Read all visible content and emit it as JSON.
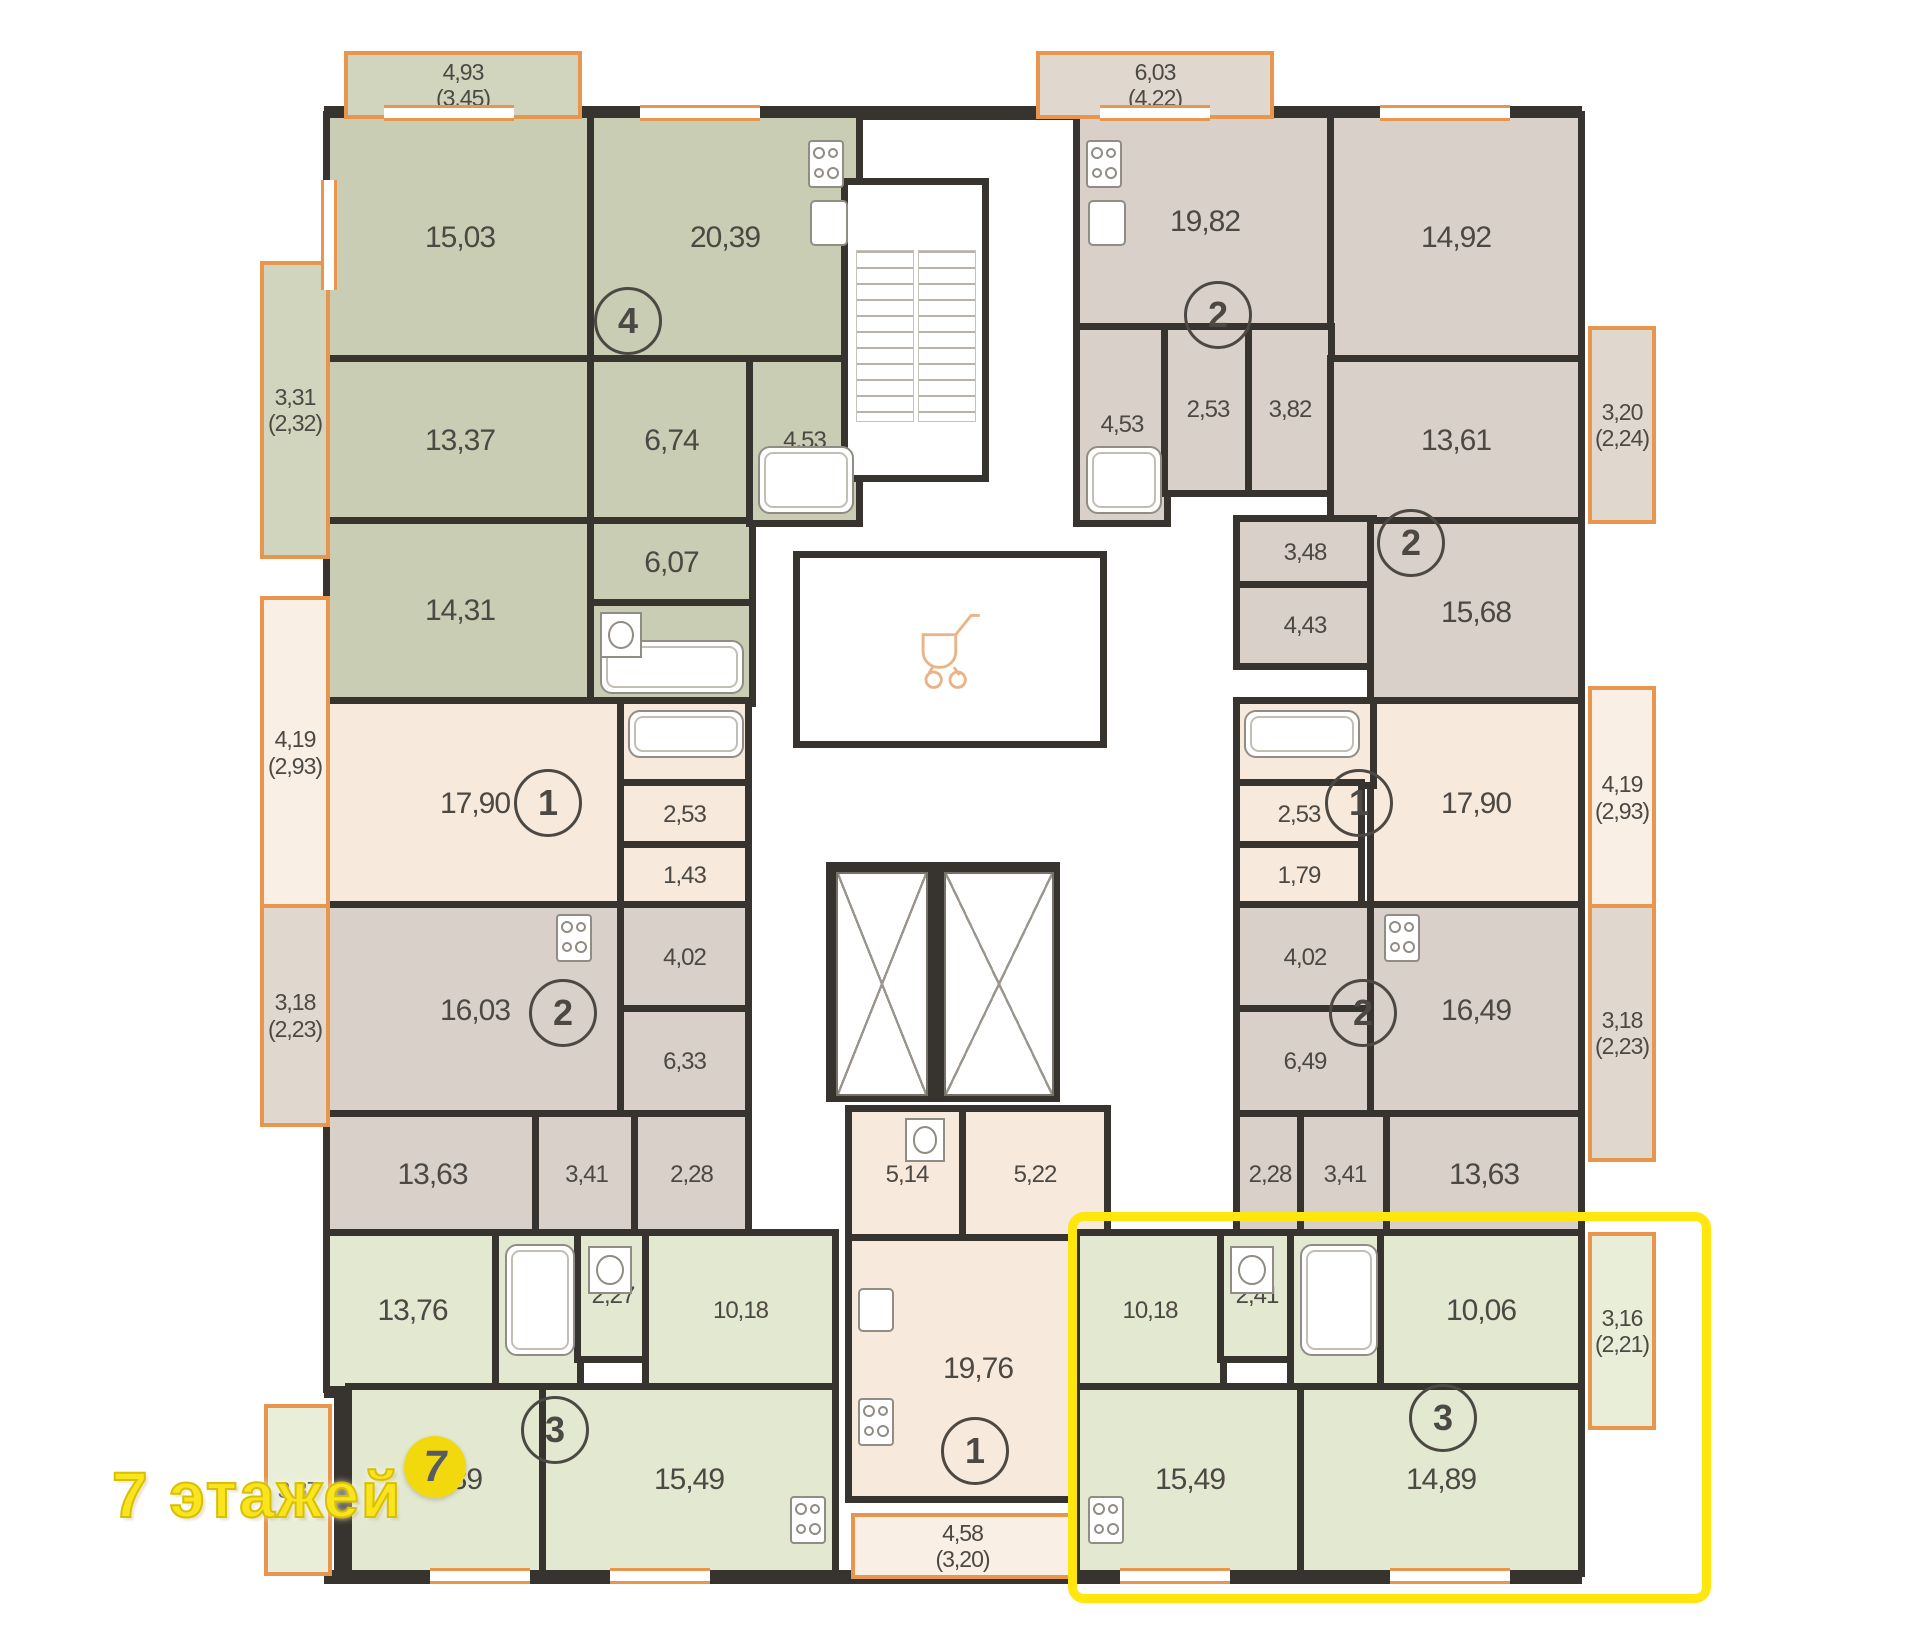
{
  "plan_title": "floor-plan",
  "watermark": {
    "text": "7 этажей",
    "logo_digit": "7"
  },
  "colors": {
    "wall": "#37332f",
    "window_accent": "#e8954e",
    "highlight": "#ffe70d",
    "apt_olive": "#c9cdb3",
    "apt_pink": "#f8e9dd",
    "apt_taupe": "#d9d1c9",
    "apt_green": "#e3e8d1",
    "label_text": "#4c4843"
  },
  "apartments": [
    {
      "number": "4",
      "color_key": "apt_olive",
      "rooms": [
        {
          "area": "15,03"
        },
        {
          "area": "20,39"
        },
        {
          "area": "13,37"
        },
        {
          "area": "6,74"
        },
        {
          "area": "14,31"
        },
        {
          "area": "6,07"
        },
        {
          "area": "4,85"
        },
        {
          "area": "4,53"
        }
      ],
      "balconies": [
        {
          "area": "4,93",
          "secondary": "(3,45)"
        },
        {
          "area": "3,31",
          "secondary": "(2,32)"
        }
      ]
    },
    {
      "number": "1",
      "color_key": "apt_pink",
      "rooms": [
        {
          "area": "17,90"
        },
        {
          "area": "4,54"
        },
        {
          "area": "2,53"
        },
        {
          "area": "1,43"
        }
      ],
      "balconies": [
        {
          "area": "4,19",
          "secondary": "(2,93)"
        }
      ]
    },
    {
      "number": "2",
      "color_key": "apt_taupe",
      "rooms": [
        {
          "area": "16,03"
        },
        {
          "area": "4,02"
        },
        {
          "area": "6,33"
        },
        {
          "area": "13,63"
        },
        {
          "area": "3,41"
        },
        {
          "area": "2,28"
        }
      ],
      "balconies": [
        {
          "area": "3,18",
          "secondary": "(2,23)"
        }
      ]
    },
    {
      "number": "3",
      "color_key": "apt_green",
      "rooms": [
        {
          "area": "13,76"
        },
        {
          "area": "3,47"
        },
        {
          "area": "2,27"
        },
        {
          "area": "10,18"
        },
        {
          "area": "14,89"
        },
        {
          "area": "15,49"
        }
      ],
      "balconies": [
        {
          "area": "3,37",
          "secondary": ""
        }
      ]
    },
    {
      "number": "1",
      "color_key": "apt_pink",
      "rooms": [
        {
          "area": "5,14"
        },
        {
          "area": "5,22"
        },
        {
          "area": "19,76"
        }
      ],
      "balconies": [
        {
          "area": "4,58",
          "secondary": "(3,20)"
        }
      ]
    },
    {
      "number": "2",
      "color_key": "apt_taupe",
      "rooms": [
        {
          "area": "19,82"
        },
        {
          "area": "14,92"
        },
        {
          "area": "4,53"
        },
        {
          "area": "2,53"
        },
        {
          "area": "3,82"
        }
      ],
      "balconies": [
        {
          "area": "6,03",
          "secondary": "(4,22)"
        }
      ]
    },
    {
      "number": "2",
      "color_key": "apt_taupe",
      "rooms": [
        {
          "area": "13,61"
        },
        {
          "area": "3,48"
        },
        {
          "area": "4,43"
        },
        {
          "area": "15,68"
        }
      ],
      "balconies": [
        {
          "area": "3,20",
          "secondary": "(2,24)"
        }
      ]
    },
    {
      "number": "1",
      "color_key": "apt_pink",
      "rooms": [
        {
          "area": "17,90"
        },
        {
          "area": "4,54"
        },
        {
          "area": "2,53"
        },
        {
          "area": "1,79"
        }
      ],
      "balconies": [
        {
          "area": "4,19",
          "secondary": "(2,93)"
        }
      ]
    },
    {
      "number": "2",
      "color_key": "apt_taupe",
      "rooms": [
        {
          "area": "4,02"
        },
        {
          "area": "6,49"
        },
        {
          "area": "16,49"
        },
        {
          "area": "2,28"
        },
        {
          "area": "3,41"
        },
        {
          "area": "13,63"
        }
      ],
      "balconies": [
        {
          "area": "3,18",
          "secondary": "(2,23)"
        }
      ]
    },
    {
      "number": "3",
      "color_key": "apt_green",
      "highlighted": true,
      "rooms": [
        {
          "area": "10,18"
        },
        {
          "area": "2,41"
        },
        {
          "area": "3,47"
        },
        {
          "area": "10,06"
        },
        {
          "area": "15,49"
        },
        {
          "area": "14,89"
        }
      ],
      "balconies": [
        {
          "area": "3,16",
          "secondary": "(2,21)"
        }
      ]
    }
  ],
  "core": {
    "stairwell": "stairs",
    "elevators": 2,
    "pram_room": "stroller"
  }
}
